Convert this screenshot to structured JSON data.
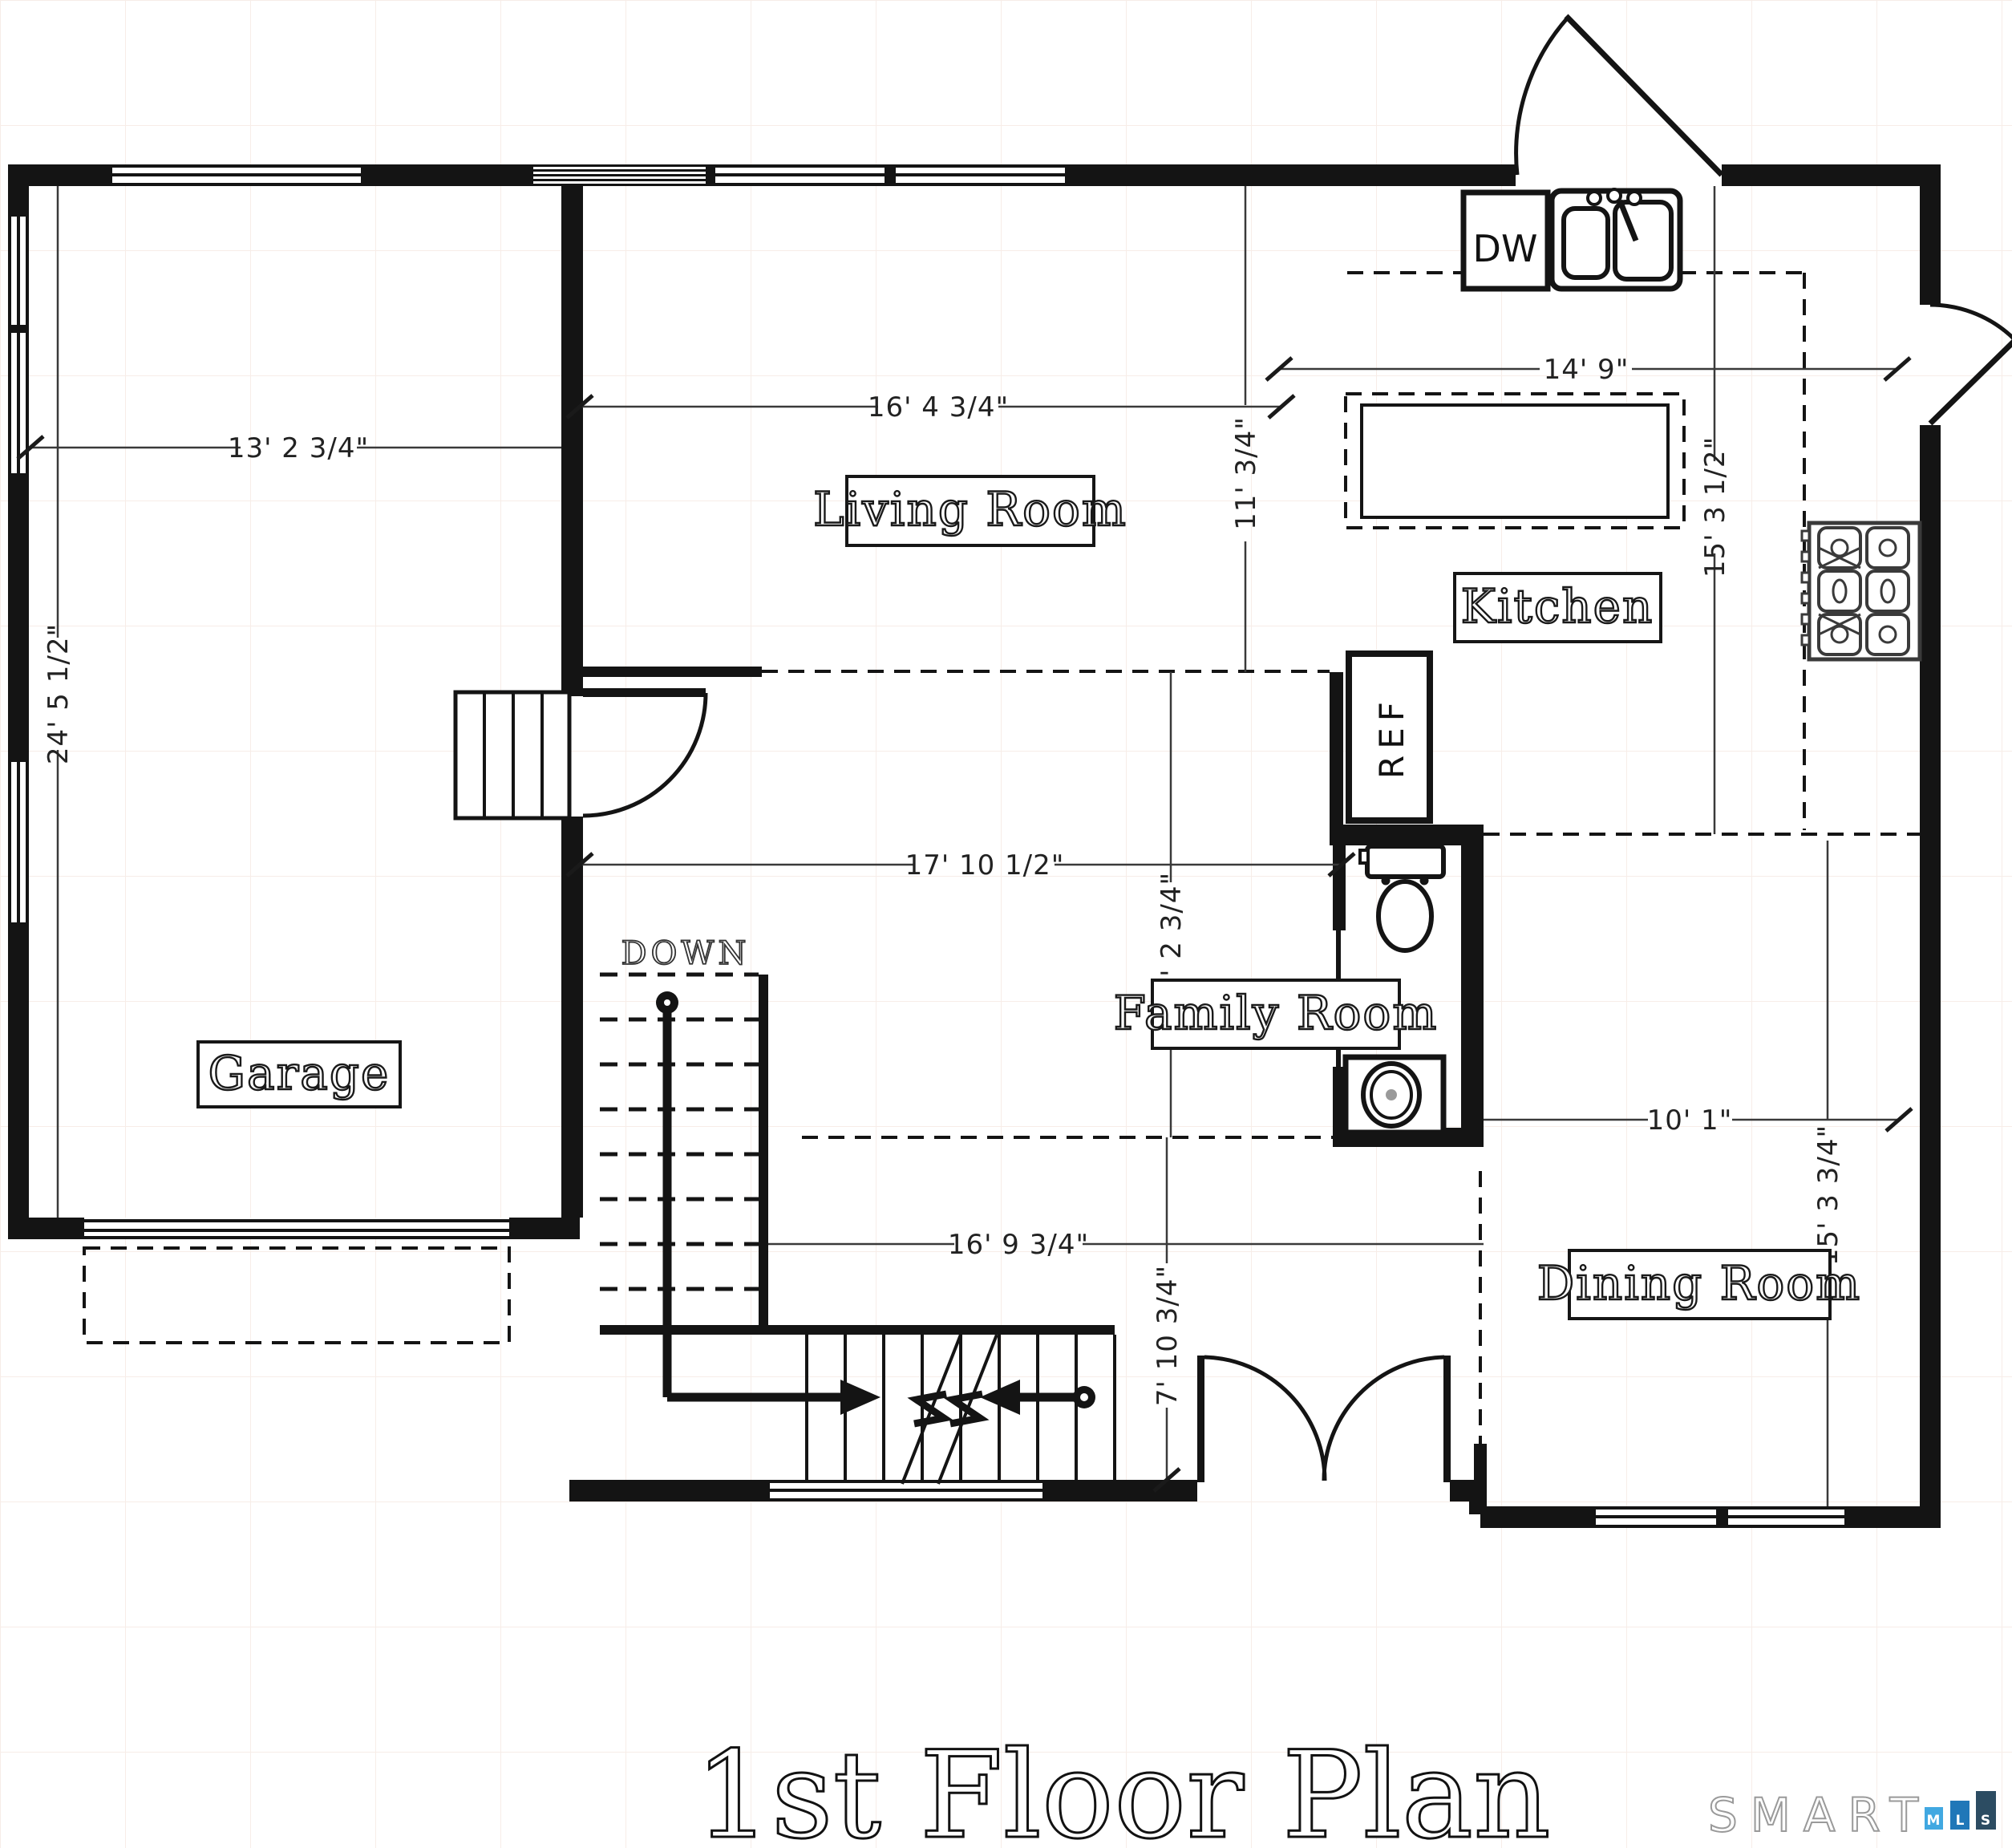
{
  "title": "1st Floor Plan",
  "rooms": [
    {
      "label": "Garage"
    },
    {
      "label": "Living Room"
    },
    {
      "label": "Kitchen"
    },
    {
      "label": "Family Room"
    },
    {
      "label": "Dining Room"
    }
  ],
  "labels": {
    "down": "DOWN",
    "dishwasher": "DW",
    "refrigerator": "REF"
  },
  "dimensions": {
    "garage_width": "13' 2 3/4\"",
    "garage_depth": "24' 5 1/2\"",
    "living_width": "16' 4 3/4\"",
    "living_depth": "11' 3/4\"",
    "kitchen_width": "14' 9\"",
    "kitchen_depth": "15' 3 1/2\"",
    "family_width": "17' 10 1/2\"",
    "family_depth": "11' 2 3/4\"",
    "stair_width": "16' 9 3/4\"",
    "foyer_depth": "7' 10 3/4\"",
    "dining_width": "10' 1\"",
    "dining_depth": "15' 3 3/4\""
  },
  "logo": {
    "brand": "SMART",
    "squares": [
      {
        "letter": "M",
        "color": "#41a8e1"
      },
      {
        "letter": "L",
        "color": "#2077b8"
      },
      {
        "letter": "S",
        "color": "#2c4c62"
      }
    ]
  },
  "colors": {
    "wall": "#141414",
    "dimension": "#3a3a3a",
    "grid": "#f7ede8"
  }
}
